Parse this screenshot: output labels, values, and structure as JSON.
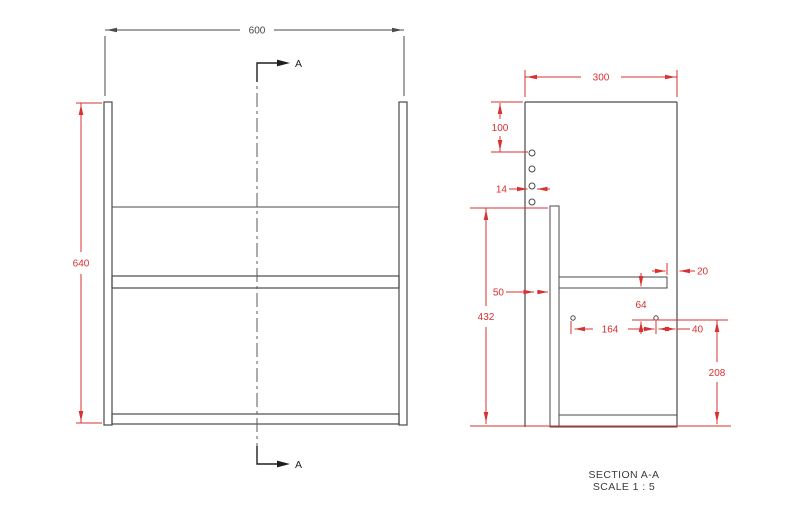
{
  "drawing": {
    "front_view": {
      "dim_width": "600",
      "dim_height": "640",
      "section_label": "A"
    },
    "section_view": {
      "dim_depth": "300",
      "dim_top_offset": "100",
      "dim_hole_diameter": "14",
      "dim_back_panel_offset": "50",
      "dim_back_panel_height": "432",
      "dim_shelf_gap": "20",
      "dim_shelf_to_holes": "64",
      "dim_hole_spacing": "164",
      "dim_hole_to_edge": "40",
      "dim_holes_to_bottom": "208"
    },
    "footer": {
      "section_title": "SECTION A-A",
      "section_scale": "SCALE 1 : 5"
    },
    "colors": {
      "dimension_red": "#d93030",
      "object_line_gray": "#4a4a4a",
      "annotation_black": "#1f1f1f",
      "background": "#ffffff"
    }
  }
}
